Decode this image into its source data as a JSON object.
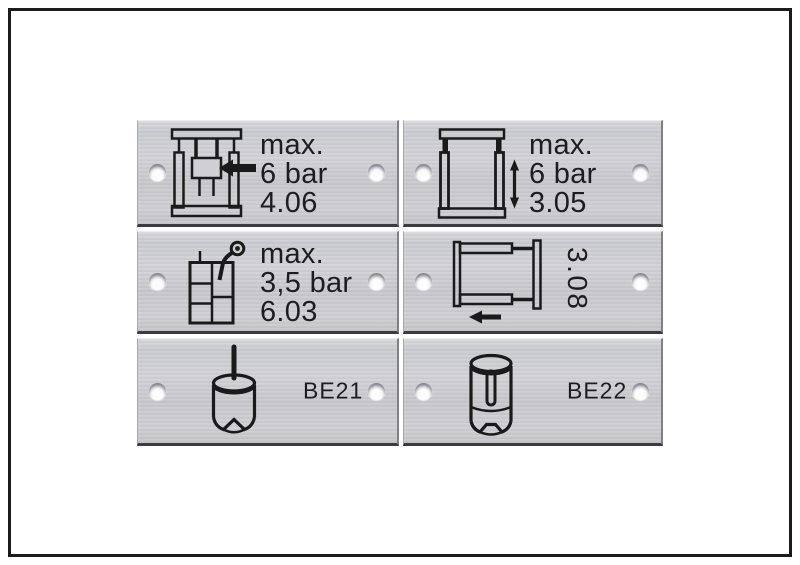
{
  "canvas": {
    "background": "#ffffff",
    "frame_color": "#1c1c1c"
  },
  "plate_style": {
    "metal_color": "#cdcdd2",
    "text_color": "#1d1d1f",
    "icon_color": "#1a1a1a"
  },
  "plates": [
    {
      "name": "vertical-press-clamp-plate",
      "icon": "press-clamp-icon",
      "lines": [
        "max.",
        "6 bar",
        "4.06"
      ]
    },
    {
      "name": "vertical-stroke-frame-plate",
      "icon": "frame-vertical-arrow-icon",
      "lines": [
        "max.",
        "6 bar",
        "3.05"
      ]
    },
    {
      "name": "tank-suction-plate",
      "icon": "tank-suction-icon",
      "lines": [
        "max.",
        "3,5 bar",
        "6.03"
      ]
    },
    {
      "name": "horizontal-stroke-frame-plate",
      "icon": "frame-horizontal-arrow-icon",
      "lines": [
        "3.08"
      ],
      "text_rotation": "90deg"
    },
    {
      "name": "punch-tool-plate",
      "icon": "punch-tool-icon",
      "lines": [
        "BE21"
      ]
    },
    {
      "name": "slotted-punch-tool-plate",
      "icon": "slotted-punch-tool-icon",
      "lines": [
        "BE22"
      ]
    }
  ]
}
